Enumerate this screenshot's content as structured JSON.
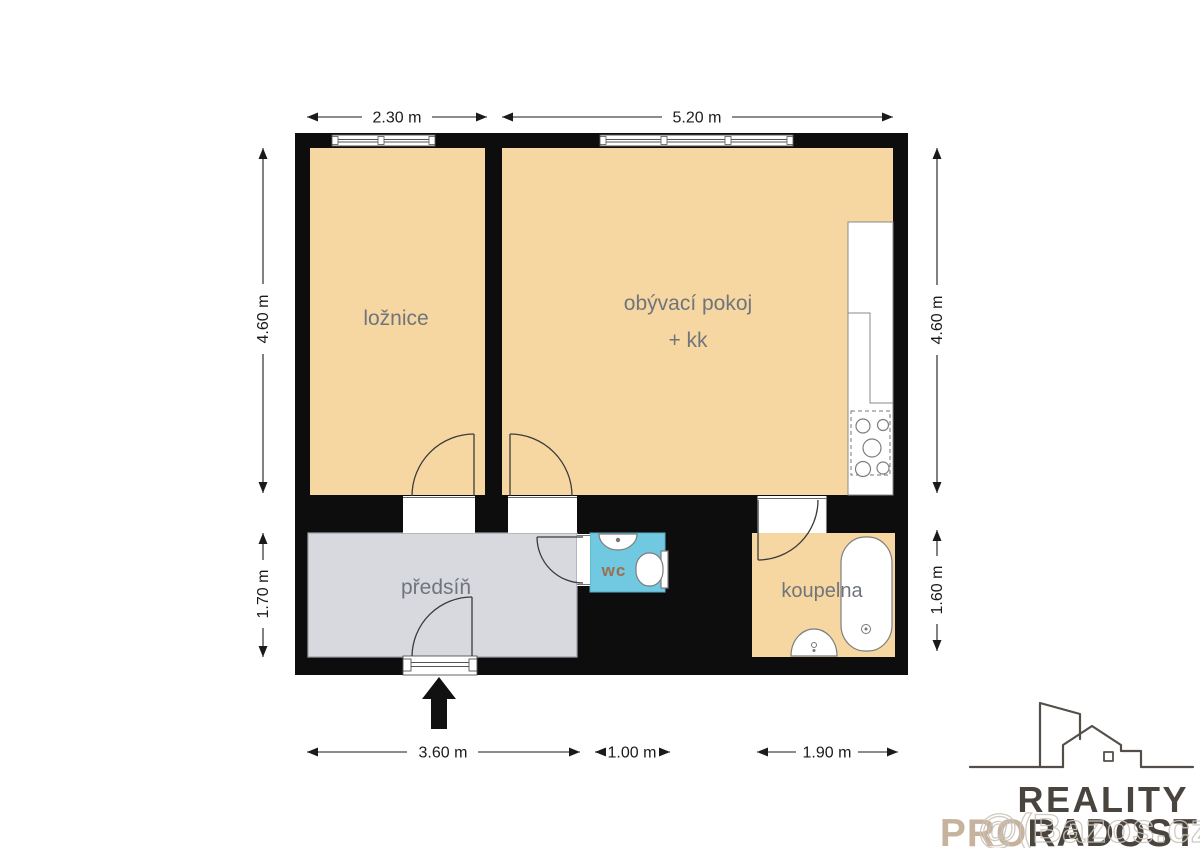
{
  "colors": {
    "wall": "#0d0d0d",
    "room_tan": "#F6D7A2",
    "hall_gray": "#D8D8DF",
    "wc_cyan": "#70C8E1",
    "label_gray": "#70757C",
    "wc_label_brown": "#9A7054",
    "logo_dark": "#4A443F",
    "logo_beige": "#C6B29D",
    "watermark_gray": "#CCC5BC"
  },
  "rooms": {
    "bedroom": {
      "label": "ložnice"
    },
    "living": {
      "label": "obývací pokoj",
      "sublabel": "+ kk"
    },
    "hall": {
      "label": "předsíň"
    },
    "wc": {
      "label": "wc"
    },
    "bathroom": {
      "label": "koupelna"
    }
  },
  "dimensions": {
    "top": [
      "2.30 m",
      "5.20 m"
    ],
    "left": [
      "4.60 m",
      "1.70 m"
    ],
    "right": [
      "4.60 m",
      "1.60 m"
    ],
    "bottom": [
      "3.60 m",
      "1.00 m",
      "1.90 m"
    ]
  },
  "logo": {
    "brand_line1": "REALITY",
    "brand_line2_pro": "PRO",
    "brand_line2_radost": "RADOST"
  },
  "watermark": {
    "text": "@(Bazos.cz"
  }
}
